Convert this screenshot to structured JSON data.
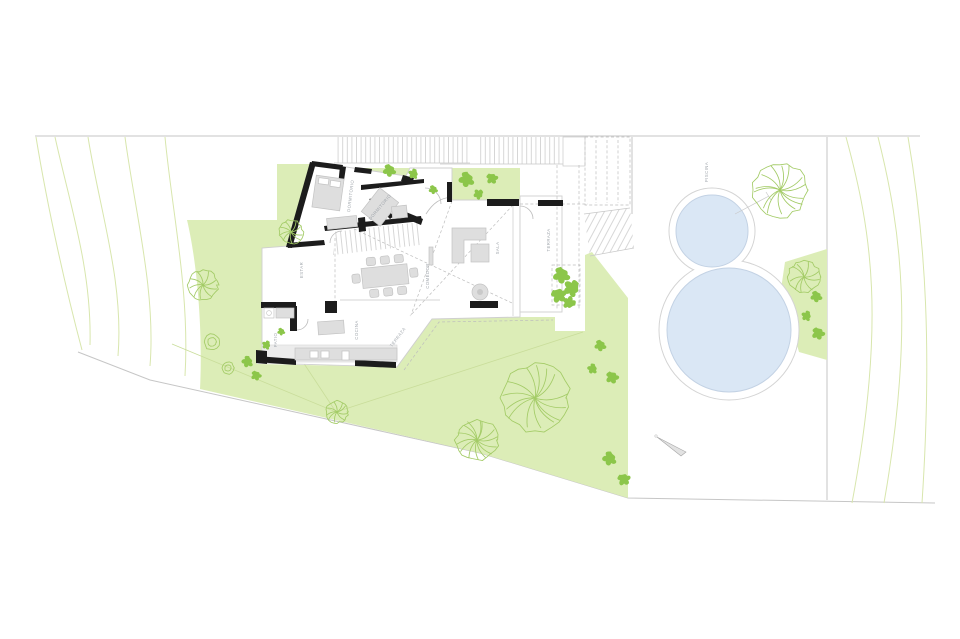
{
  "labels": {
    "dormitorio_1": "DORMITORIO",
    "dormitorio_2": "DORMITORIO",
    "estar": "ESTAR",
    "comedor": "COMEDOR",
    "sala": "SALA",
    "cocina": "COCINA",
    "patio": "PATIO",
    "terraza_lower": "TERRAZA",
    "terraza_east": "TERRAZA",
    "piscina": "PISCINA"
  },
  "colors": {
    "lawn": "#dcedb7",
    "lawn-edge": "#c9dd9a",
    "contour": "#d8e6ad",
    "boundary": "#c6c6c6",
    "slab": "#cfcfcf",
    "wall": "#1c1c1c",
    "furniture": "#dedede",
    "foliage": "#a3cb66",
    "leaf": "#8cc64a",
    "pool": "#dae7f5",
    "pool-edge": "#c3d2e4",
    "pool-ring": "#d4d4d4",
    "label": "#a0a6ac"
  }
}
